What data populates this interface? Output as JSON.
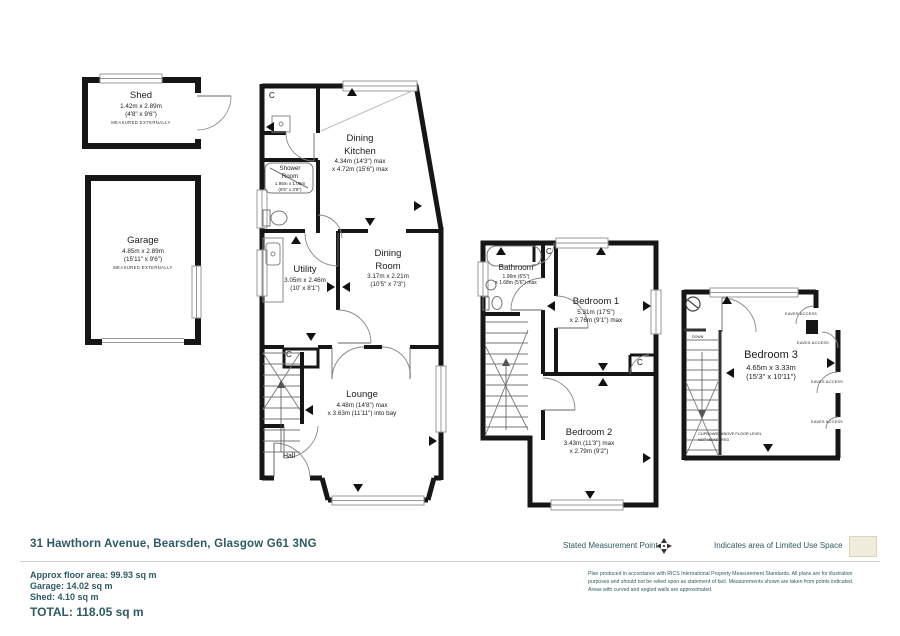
{
  "colors": {
    "wall": "#161616",
    "text_teal": "#2e5a63",
    "limited_use_beige": "#f0eddc"
  },
  "rooms": {
    "shed": {
      "name": "Shed",
      "dims_metric": "1.42m x 2.89m",
      "dims_imperial": "(4'8\" x 9'6\")",
      "note": "MEASURED EXTERNALLY"
    },
    "garage": {
      "name": "Garage",
      "dims_metric": "4.85m x 2.89m",
      "dims_imperial": "(15'11\" x 9'6\")",
      "note": "MEASURED EXTERNALLY"
    },
    "dining_kitchen": {
      "name_line1": "Dining",
      "name_line2": "Kitchen",
      "dims_line1": "4.34m (14'3\") max",
      "dims_line2": "x 4.72m (15'6\") max"
    },
    "shower_room": {
      "name_line1": "Shower",
      "name_line2": "Room",
      "dims_line1": "1.95m x 1.06m",
      "dims_line2": "(6'5\" x 3'6\")"
    },
    "utility": {
      "name": "Utility",
      "dims_line1": "3.05m x 2.46m",
      "dims_line2": "(10' x 8'1\")"
    },
    "dining_room": {
      "name_line1": "Dining",
      "name_line2": "Room",
      "dims_line1": "3.17m x 2.21m",
      "dims_line2": "(10'5\" x 7'3\")"
    },
    "lounge": {
      "name": "Lounge",
      "dims_line1": "4.48m (14'8\") max",
      "dims_line2": "x 3.63m (11'11\") into bay"
    },
    "hall": {
      "name": "Hall"
    },
    "bathroom": {
      "name": "Bathroom",
      "dims_line1": "1.96m (6'5\")",
      "dims_line2": "x 1.68m (5'6\") max"
    },
    "bedroom1": {
      "name": "Bedroom 1",
      "dims_line1": "5.31m (17'5\")",
      "dims_line2": "x 2.76m (9'1\") max"
    },
    "bedroom2": {
      "name": "Bedroom 2",
      "dims_line1": "3.43m (11'3\") max",
      "dims_line2": "x 2.79m (9'2\")"
    },
    "bedroom3": {
      "name": "Bedroom 3",
      "dims_line1": "4.65m x 3.33m",
      "dims_line2": "(15'3\" x 10'11\")"
    }
  },
  "annotations": {
    "cupboard_letter": "C",
    "eaves_access": "EAVES ACCESS",
    "cupboard_note_line1": "CUPBOARD ABOVE FLOOR LEVEL",
    "cupboard_note_line2": "NOT MEASURED",
    "down_label": "DOWN"
  },
  "footer": {
    "address": "31 Hawthorn Avenue, Bearsden, Glasgow G61 3NG",
    "legend_measurement": "Stated Measurement Point",
    "legend_limited_use": "Indicates area of  Limited Use Space",
    "area_line1": "Approx floor area: 99.93 sq m",
    "area_line2": "Garage: 14.02 sq m",
    "area_line3": "Shed:  4.10 sq m",
    "area_total": "TOTAL: 118.05 sq m",
    "disclaimer_line1": "Plan produced in accordance with RICS International Property Measurement Standards.  All plans are for illustration",
    "disclaimer_line2": "purposes and should not be relied upon as statement of fact.  Measurements shown are taken from points indicated.",
    "disclaimer_line3": "Areas with curved and angled walls are approximated."
  }
}
